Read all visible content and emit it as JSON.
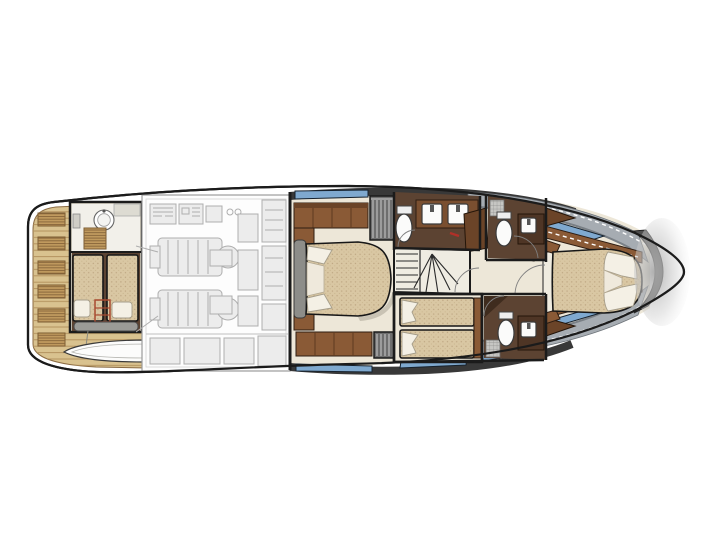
{
  "meta": {
    "description": "Top-view lower-deck floor plan of a motor yacht, bow pointing right, stern swim platform with tender on the left",
    "visible_text": ""
  },
  "palette": {
    "hull_outline": "#1b1b1b",
    "teak": "#d9c28f",
    "teak_line": "#b3925e",
    "teak_grate": "#c09a5e",
    "engine_line": "#aeaeae",
    "engine_fill": "#ececec",
    "floor_cream": "#ede7d8",
    "walnut": "#8a5a36",
    "walnut_dark": "#6b4428",
    "floor_brown": "#5c4332",
    "wall_dark": "#383838",
    "wall_gray": "#6e6e6e",
    "deck_gray": "#a6acb2",
    "window_blue": "#7fa9cf",
    "window_edge": "#15212d",
    "mattress": "#d9c7a3",
    "mattress_dot": "#bda581",
    "pillow": "#f4f0e5",
    "fixture_white": "#fbfbfa",
    "accent_red": "#b03028",
    "bench_gray": "#9b9b97",
    "tender_white": "#fcfcfb",
    "bow_shade": "#adadad"
  },
  "regions": [
    {
      "id": "swim-platform",
      "label": "teak swim platform with six grates"
    },
    {
      "id": "tender-boat",
      "label": "tender dinghy stowed on platform"
    },
    {
      "id": "crew-cabin",
      "label": "crew cabin with two berths and shower room"
    },
    {
      "id": "engine-room",
      "label": "engine room with twin engines (ghosted line work)"
    },
    {
      "id": "master-cabin",
      "label": "full-beam master cabin with island bed"
    },
    {
      "id": "master-bathroom",
      "label": "master bathroom with toilet and twin sinks"
    },
    {
      "id": "staircase",
      "label": "curved companionway stairs"
    },
    {
      "id": "twin-cabin",
      "label": "twin guest cabin with two single beds"
    },
    {
      "id": "twin-ensuite",
      "label": "guest bathroom with toilet and sink"
    },
    {
      "id": "day-head",
      "label": "forward bathroom with toilet, sink and shower"
    },
    {
      "id": "vip-cabin",
      "label": "VIP bow cabin with island bed"
    },
    {
      "id": "side-decks",
      "label": "gray side decks with hull windows"
    },
    {
      "id": "bow",
      "label": "bow tip with bulkhead"
    }
  ],
  "fixture_counts": {
    "toilets": 4,
    "sinks_basins": 5,
    "beds": 6,
    "engines": 2,
    "hull_windows": 8
  }
}
